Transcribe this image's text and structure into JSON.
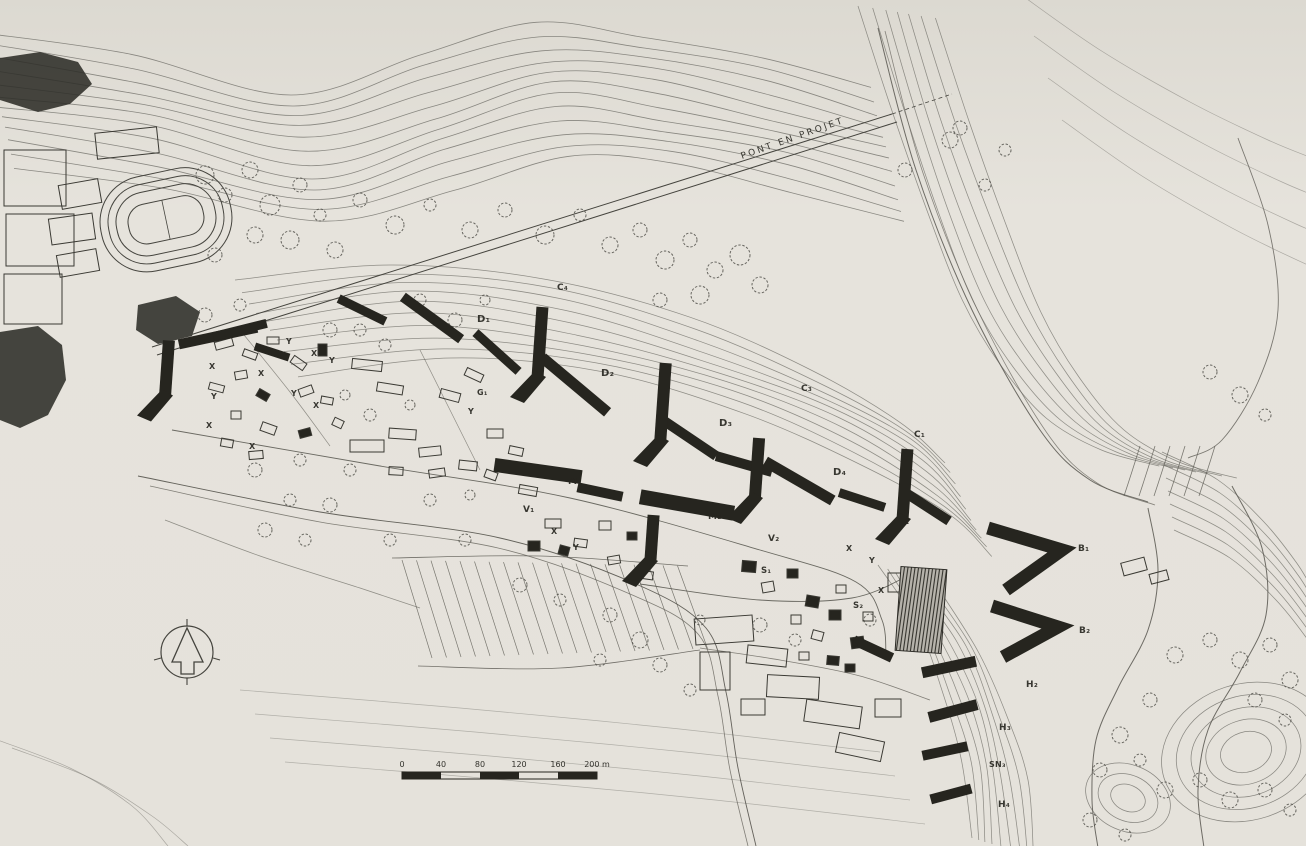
{
  "map": {
    "type": "scanned hand-drawn site plan",
    "paper_color": "#e5e2db",
    "ink_color": "#26251f",
    "contour_color": "#72706a",
    "compass_icon": "north-arrow",
    "scale_bar": {
      "ticks": [
        "0",
        "40",
        "80",
        "120",
        "160",
        "200 m"
      ]
    },
    "labels": [
      {
        "text": "PONT EN PROJET",
        "x": 742,
        "y": 159,
        "s": 9,
        "r": -19.5,
        "ls": 2.4,
        "w": 400
      },
      {
        "text": "C₄",
        "x": 557,
        "y": 290,
        "s": 9
      },
      {
        "text": "C₃",
        "x": 801,
        "y": 391,
        "s": 9
      },
      {
        "text": "C₁",
        "x": 914,
        "y": 437,
        "s": 9
      },
      {
        "text": "D₁",
        "x": 477,
        "y": 322,
        "s": 10
      },
      {
        "text": "D₂",
        "x": 601,
        "y": 376,
        "s": 10
      },
      {
        "text": "D₃",
        "x": 719,
        "y": 426,
        "s": 10
      },
      {
        "text": "D₄",
        "x": 833,
        "y": 475,
        "s": 10
      },
      {
        "text": "M",
        "x": 568,
        "y": 484,
        "s": 9
      },
      {
        "text": "M₂",
        "x": 708,
        "y": 519,
        "s": 9
      },
      {
        "text": "V₁",
        "x": 523,
        "y": 512,
        "s": 9
      },
      {
        "text": "V₂",
        "x": 768,
        "y": 541,
        "s": 9
      },
      {
        "text": "E",
        "x": 903,
        "y": 524,
        "s": 9
      },
      {
        "text": "S₁",
        "x": 761,
        "y": 573,
        "s": 8.5
      },
      {
        "text": "S₂",
        "x": 853,
        "y": 608,
        "s": 8.5
      },
      {
        "text": "G₁",
        "x": 477,
        "y": 395,
        "s": 8
      },
      {
        "text": "B₁",
        "x": 1078,
        "y": 551,
        "s": 9
      },
      {
        "text": "B₂",
        "x": 1079,
        "y": 633,
        "s": 9
      },
      {
        "text": "H₂",
        "x": 1026,
        "y": 687,
        "s": 9
      },
      {
        "text": "H₃",
        "x": 999,
        "y": 730,
        "s": 9
      },
      {
        "text": "SN₃",
        "x": 989,
        "y": 767,
        "s": 8
      },
      {
        "text": "H₄",
        "x": 998,
        "y": 807,
        "s": 9
      },
      {
        "text": "X",
        "x": 209,
        "y": 369,
        "s": 8
      },
      {
        "text": "X",
        "x": 258,
        "y": 376,
        "s": 8
      },
      {
        "text": "X",
        "x": 311,
        "y": 356,
        "s": 8
      },
      {
        "text": "X",
        "x": 313,
        "y": 408,
        "s": 8
      },
      {
        "text": "X",
        "x": 206,
        "y": 428,
        "s": 8
      },
      {
        "text": "X",
        "x": 249,
        "y": 449,
        "s": 8
      },
      {
        "text": "X",
        "x": 551,
        "y": 534,
        "s": 8
      },
      {
        "text": "X",
        "x": 846,
        "y": 551,
        "s": 8
      },
      {
        "text": "X",
        "x": 878,
        "y": 593,
        "s": 8
      },
      {
        "text": "X",
        "x": 853,
        "y": 648,
        "s": 8
      },
      {
        "text": "Y",
        "x": 286,
        "y": 344,
        "s": 8
      },
      {
        "text": "Y",
        "x": 329,
        "y": 363,
        "s": 8
      },
      {
        "text": "Y",
        "x": 211,
        "y": 399,
        "s": 8
      },
      {
        "text": "Y",
        "x": 291,
        "y": 396,
        "s": 8
      },
      {
        "text": "Y",
        "x": 468,
        "y": 414,
        "s": 8
      },
      {
        "text": "Y",
        "x": 573,
        "y": 550,
        "s": 8
      },
      {
        "text": "Y",
        "x": 869,
        "y": 563,
        "s": 8
      }
    ]
  }
}
